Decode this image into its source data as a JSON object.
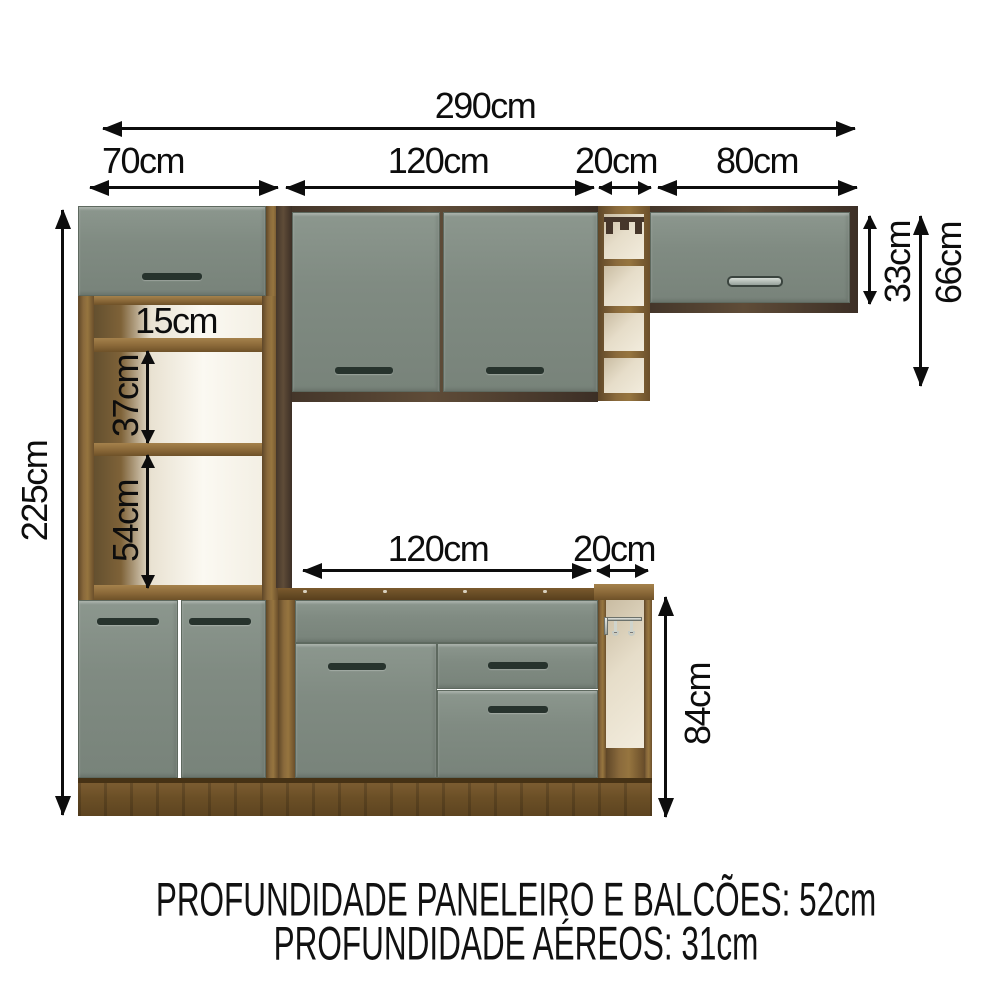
{
  "diagram": {
    "title": "kitchen-cabinet-dimension-diagram",
    "dims": {
      "total_width": "290cm",
      "tower_width": "70cm",
      "upper_cabinet_width": "120cm",
      "upper_niche_width": "20cm",
      "upper_right_width": "80cm",
      "total_height": "225cm",
      "tower_gap_top": "15cm",
      "tower_gap_middle": "37cm",
      "tower_gap_bottom": "54cm",
      "upper_right_height": "33cm",
      "upper_section_height": "66cm",
      "base_cabinet_width": "120cm",
      "base_niche_width": "20cm",
      "base_height": "84cm"
    },
    "footer": {
      "line1": "PROFUNDIDADE PANELEIRO E BALCÕES: 52cm",
      "line2": "PROFUNDIDADE AÉREOS: 31cm"
    },
    "colors": {
      "door_front": "#7e897f",
      "wood_light": "#8a6a3c",
      "wood_dark": "#4f3f30",
      "plinth_wood": "#6b4f27",
      "niche_interior": "#ece4d2",
      "handle_dark": "#27332d",
      "handle_metal": "#aeb8b1",
      "dimension_text": "#0d0d0d"
    }
  }
}
